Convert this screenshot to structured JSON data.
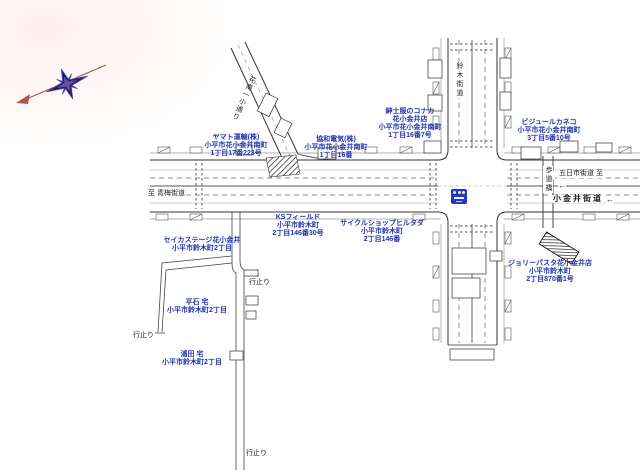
{
  "map_type": "japanese-residential-map",
  "pois": [
    {
      "id": "yamato",
      "lines": [
        "ヤマト運輸(株)",
        "小平市花小金井南町",
        "1丁目17番223号"
      ]
    },
    {
      "id": "kyowa-denki",
      "lines": [
        "協和電気(株)",
        "小平市花小金井南町",
        "1丁目16番"
      ]
    },
    {
      "id": "konaka",
      "lines": [
        "紳士服のコナカ",
        "花小金井店",
        "小平市花小金井南町",
        "1丁目16番7号"
      ]
    },
    {
      "id": "bijoule-kaneko",
      "lines": [
        "ビジュールカネコ",
        "小平市花小金井南町",
        "3丁目5番10号"
      ]
    },
    {
      "id": "ks-field",
      "lines": [
        "KSフィールド",
        "小平市鈴木町",
        "2丁目146番30号"
      ]
    },
    {
      "id": "cycle-shop",
      "lines": [
        "サイクルショップヒルタダ",
        "小平市鈴木町",
        "2丁目146番"
      ]
    },
    {
      "id": "jolly-pasta",
      "lines": [
        "ジョリーパスタ花小金井店",
        "小平市鈴木町",
        "2丁目870番1号"
      ]
    },
    {
      "id": "seika-stage",
      "lines": [
        "セイカステージ花小金井",
        "小平市鈴木町2丁目"
      ]
    },
    {
      "id": "hiraishi",
      "lines": [
        "平石 宅",
        "小平市鈴木町2丁目"
      ]
    },
    {
      "id": "urata",
      "lines": [
        "浦田 宅",
        "小平市鈴木町2丁目"
      ]
    }
  ],
  "roads": {
    "suzuki_kaido": "鈴木街道",
    "kanan_dori": "花南一小通り",
    "to_ome_kaido": "至 青梅街道",
    "itsukaichi_kaido": "五日市街道 至",
    "koganei_kaido": "小金井街道",
    "pedestrian_bridge": "歩道橋",
    "dead_end": "行止り",
    "arrow_left": "←"
  },
  "icons": {
    "compass": "compass-rose",
    "signal": "traffic-signal-icon",
    "bridge": "pedestrian-bridge-stairs"
  },
  "colors": {
    "poi_label": "#2233b0",
    "road_line": "#333333",
    "compass_needle": "#b05548",
    "compass_star": "#1c1c72",
    "signal_box": "#2238c8"
  }
}
